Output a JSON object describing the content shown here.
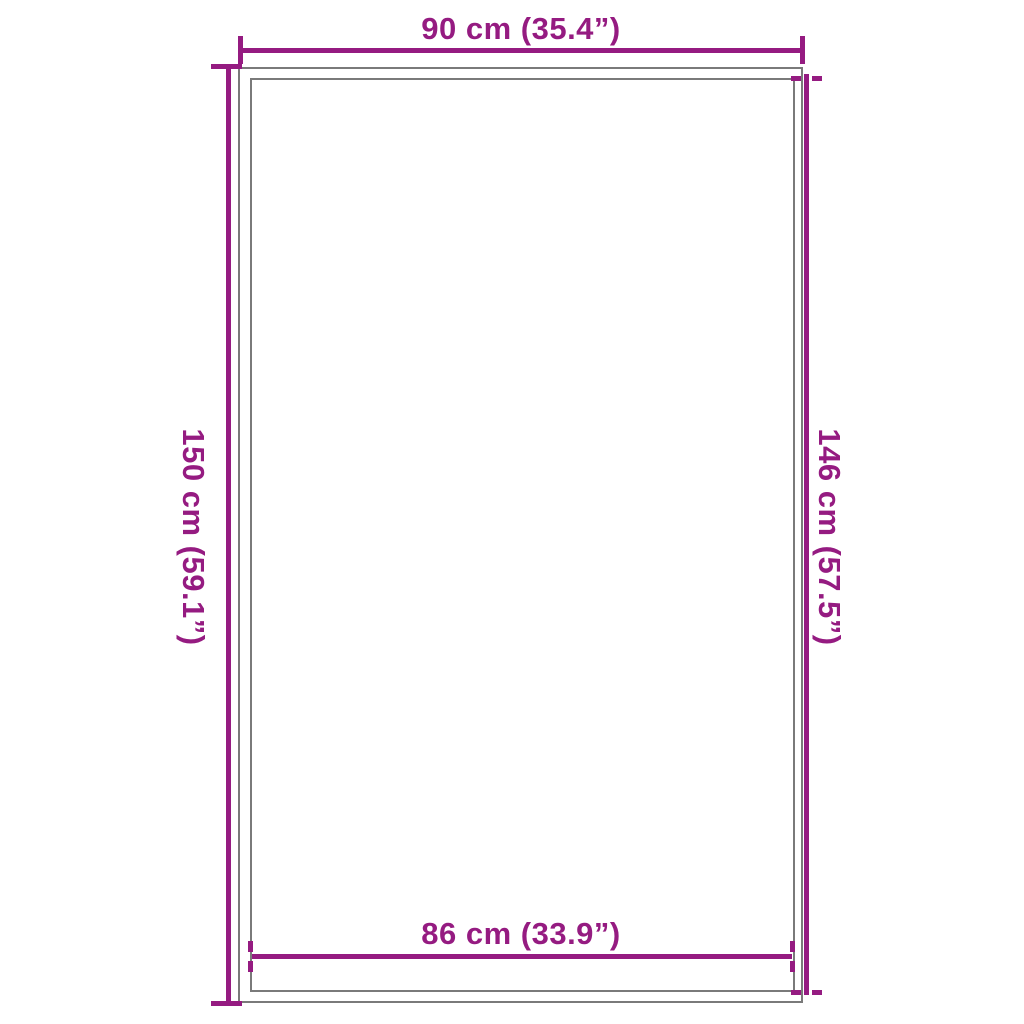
{
  "diagram": {
    "type": "product-dimension-diagram",
    "colors": {
      "dimension": "#951b81",
      "outline": "#7a7a7a",
      "background": "#ffffff"
    },
    "dimensions": {
      "top": {
        "label": "90 cm (35.4”)",
        "value_cm": 90,
        "value_in": 35.4
      },
      "left": {
        "label": "150 cm (59.1”)",
        "value_cm": 150,
        "value_in": 59.1
      },
      "right": {
        "label": "146 cm (57.5”)",
        "value_cm": 146,
        "value_in": 57.5
      },
      "bottom": {
        "label": "86 cm (33.9”)",
        "value_cm": 86,
        "value_in": 33.9
      }
    }
  }
}
